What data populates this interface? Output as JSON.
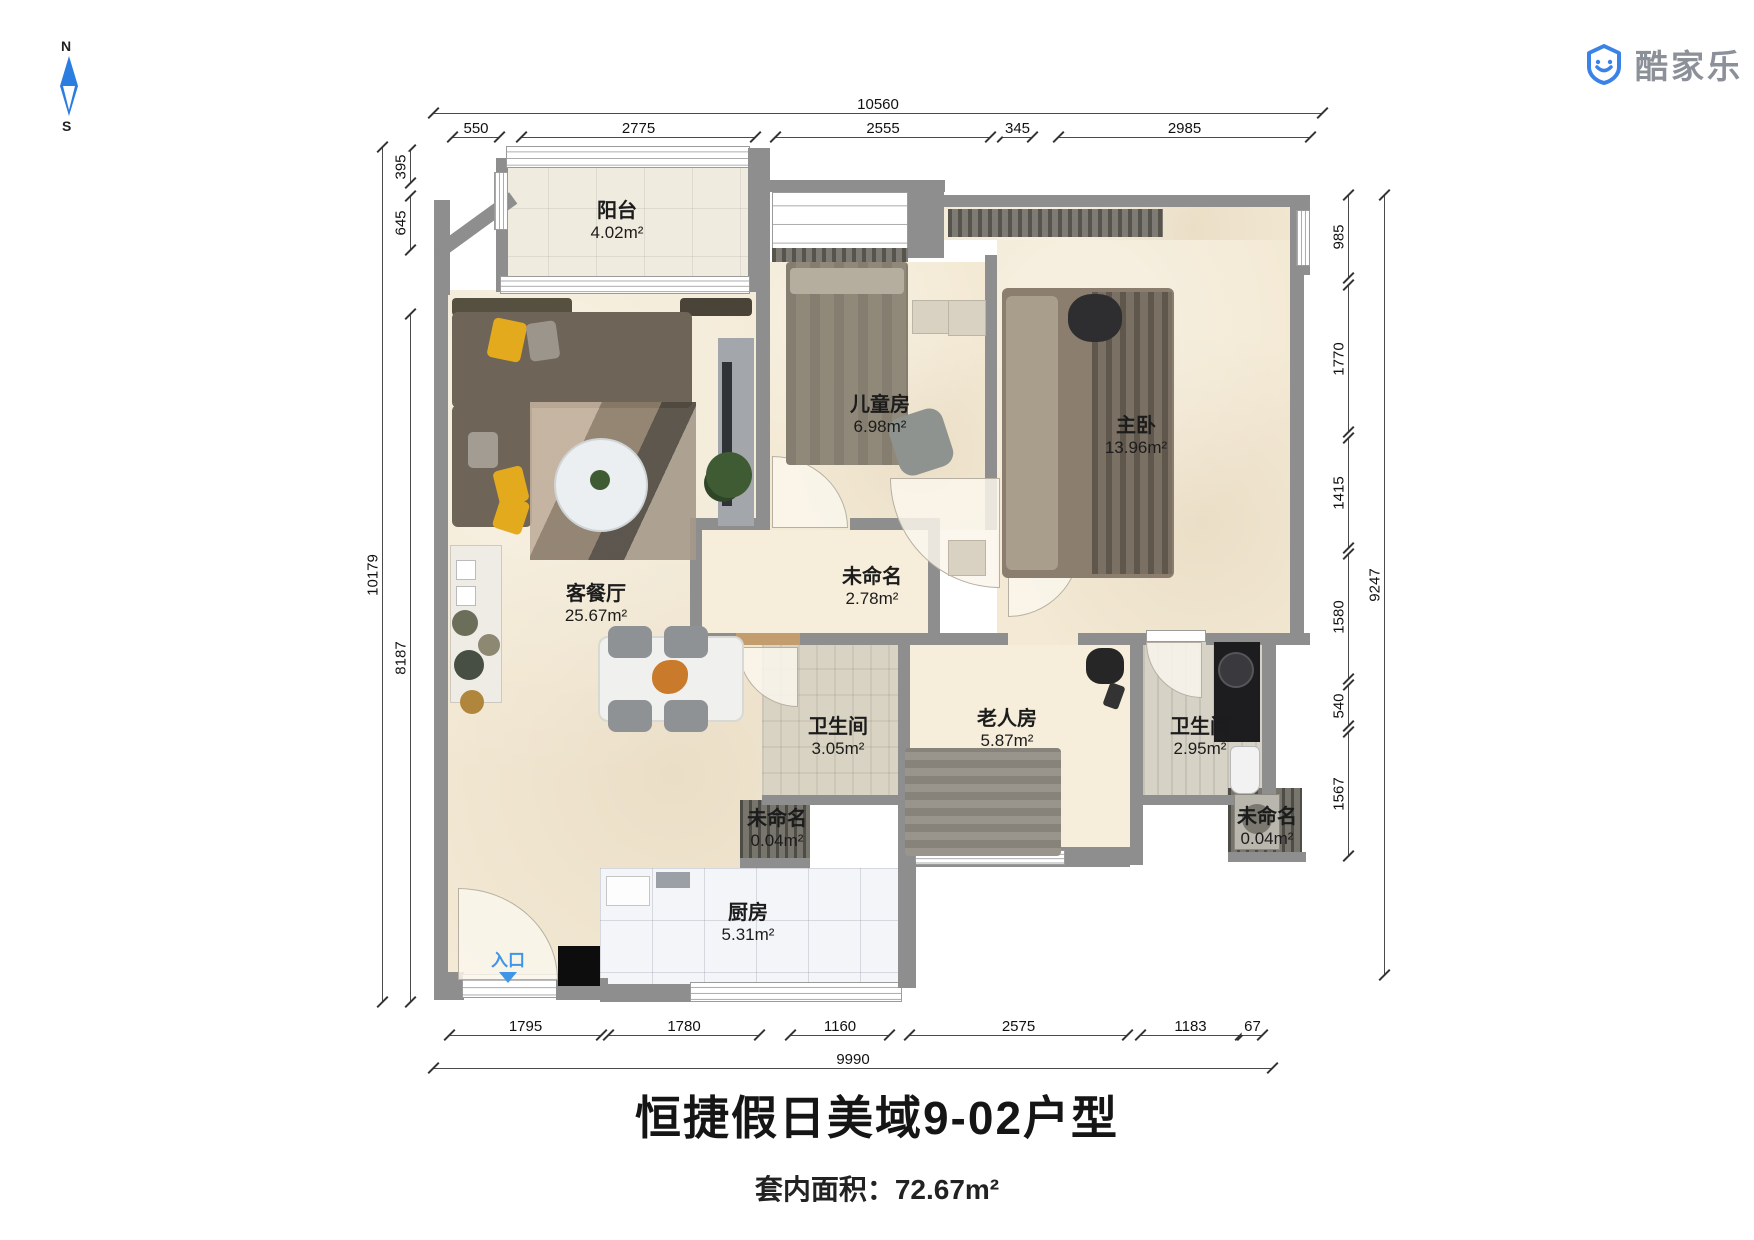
{
  "title": "恒捷假日美域9-02户型",
  "subtitle": "套内面积：72.67m²",
  "compass": {
    "north": "N",
    "south": "S"
  },
  "logo": {
    "text": "酷家乐"
  },
  "entrance": {
    "label": "入口"
  },
  "rooms": [
    {
      "name": "阳台",
      "area": "4.02m²"
    },
    {
      "name": "客餐厅",
      "area": "25.67m²"
    },
    {
      "name": "儿童房",
      "area": "6.98m²"
    },
    {
      "name": "主卧",
      "area": "13.96m²"
    },
    {
      "name": "未命名",
      "area": "2.78m²"
    },
    {
      "name": "卫生间",
      "area": "3.05m²"
    },
    {
      "name": "老人房",
      "area": "5.87m²"
    },
    {
      "name": "卫生间",
      "area": "2.95m²"
    },
    {
      "name": "未命名",
      "area": "0.04m²"
    },
    {
      "name": "未命名",
      "area": "0.04m²"
    },
    {
      "name": "厨房",
      "area": "5.31m²"
    }
  ],
  "dimensions": {
    "top": {
      "total": "10560",
      "segments": [
        "550",
        "2775",
        "2555",
        "345",
        "2985"
      ]
    },
    "bottom": {
      "total": "9990",
      "segments": [
        "1795",
        "1780",
        "1160",
        "2575",
        "1183",
        "67"
      ]
    },
    "left": {
      "total": "10179",
      "segments": [
        "395",
        "645",
        "8187"
      ]
    },
    "right": {
      "total": "9247",
      "segments": [
        "985",
        "1770",
        "1415",
        "1580",
        "540",
        "1567"
      ]
    }
  },
  "colors": {
    "wall": "#8e8e8e",
    "accent_blue": "#2b7de0",
    "entrance_blue": "#3f96e8",
    "floor_cream": "#f3e9d4",
    "logo_gray": "#8c9099"
  }
}
